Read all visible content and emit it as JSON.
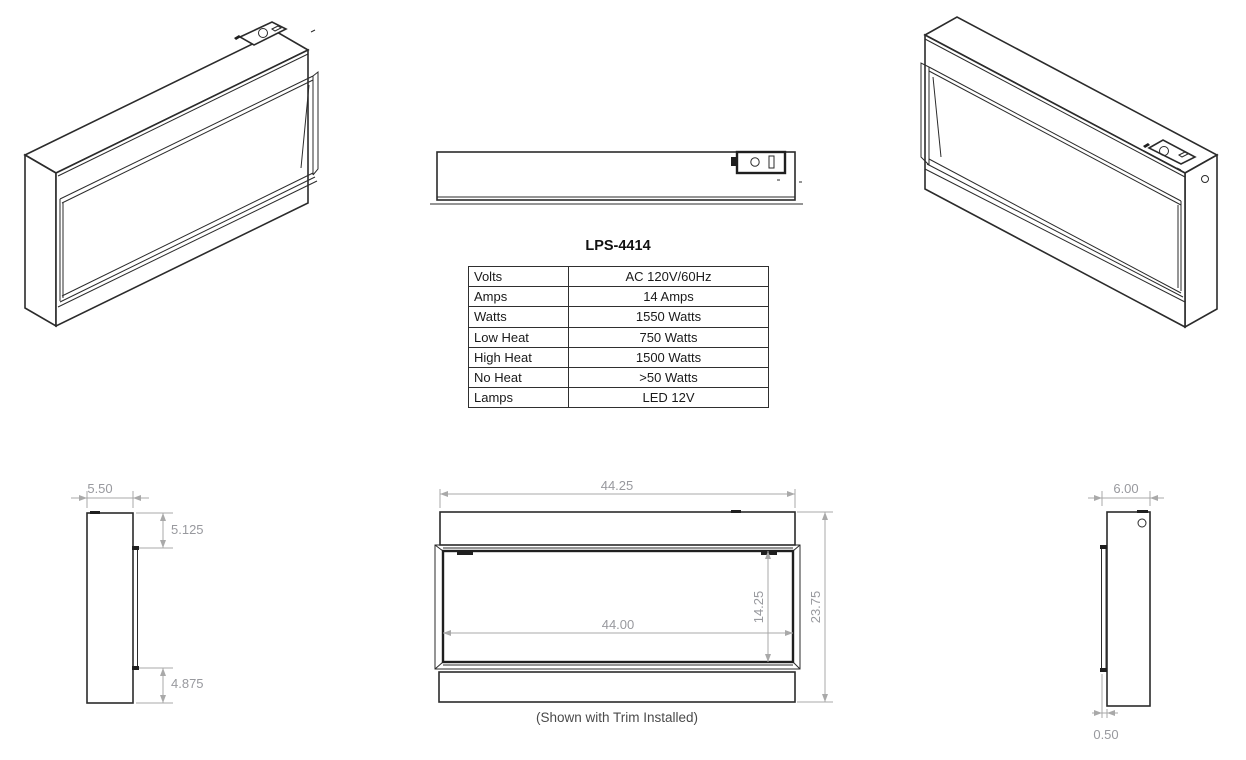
{
  "product": {
    "model": "LPS-4414"
  },
  "spec_table": {
    "rows": [
      {
        "label": "Volts",
        "value": "AC 120V/60Hz"
      },
      {
        "label": "Amps",
        "value": "14 Amps"
      },
      {
        "label": "Watts",
        "value": "1550 Watts"
      },
      {
        "label": "Low Heat",
        "value": "750 Watts"
      },
      {
        "label": "High Heat",
        "value": "1500 Watts"
      },
      {
        "label": "No Heat",
        "value": ">50 Watts"
      },
      {
        "label": "Lamps",
        "value": "LED 12V"
      }
    ]
  },
  "front_view": {
    "overall_width": "44.25",
    "opening_width": "44.00",
    "opening_height": "14.25",
    "overall_height": "23.75",
    "caption": "(Shown with Trim Installed)"
  },
  "left_side_view": {
    "depth": "5.50",
    "top_inset": "5.125",
    "bottom_inset": "4.875"
  },
  "right_side_view": {
    "depth": "6.00",
    "front_protrusion": "0.50"
  },
  "colors": {
    "drawing_line": "#2b2b2b",
    "dimension_line": "#a9a9a9",
    "dimension_text": "#98999e",
    "table_border": "#2f2f2f"
  }
}
